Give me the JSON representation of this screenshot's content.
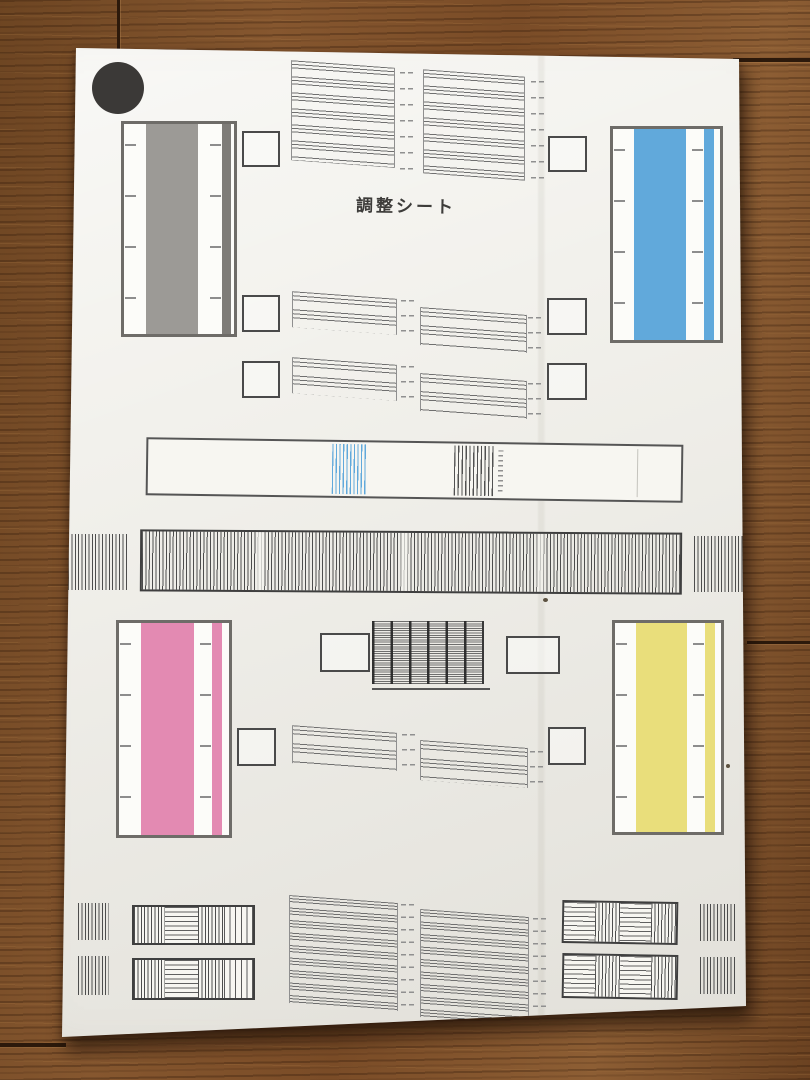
{
  "title": "調整シート",
  "colors": {
    "floor_base": "#7b4f29",
    "floor_seam": "#2c190b",
    "paper": "#f2f1ec",
    "registration_dot": "#3b3937",
    "frame": "#6e6c68",
    "pattern_line": "#6f6f6f",
    "ink_gray": "#9c9a96",
    "ink_cyan": "#61a9db",
    "ink_magenta": "#e38ab2",
    "ink_yellow": "#e9de7b"
  },
  "ink_bars": [
    {
      "name": "gray",
      "color": "#9c9a96"
    },
    {
      "name": "cyan",
      "color": "#61a9db"
    },
    {
      "name": "magenta",
      "color": "#e38ab2"
    },
    {
      "name": "yellow",
      "color": "#e9de7b"
    }
  ]
}
